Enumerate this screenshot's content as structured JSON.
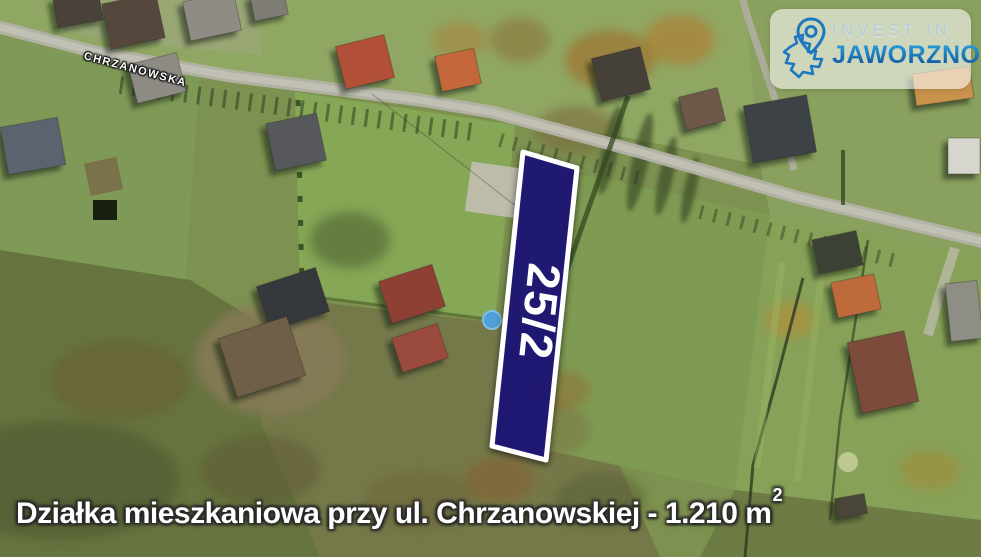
{
  "map": {
    "street_label": "CHRZANOWSKA",
    "parcel": {
      "label": "25/2",
      "fill_color": "#1d1876",
      "border_color": "#ffffff"
    }
  },
  "logo": {
    "line1": "INVEST IN",
    "line2": "JAWORZNO",
    "pin_icon": "map-pin",
    "accent_color": "#1e78be",
    "line1_color": "#b4cbdd",
    "line2_gradient_top": "#2ba2dc",
    "line2_gradient_bottom": "#134f98"
  },
  "caption": {
    "text": "Działka mieszkaniowa przy ul. Chrzanowskiej - 1.210 m",
    "superscript": "2"
  }
}
